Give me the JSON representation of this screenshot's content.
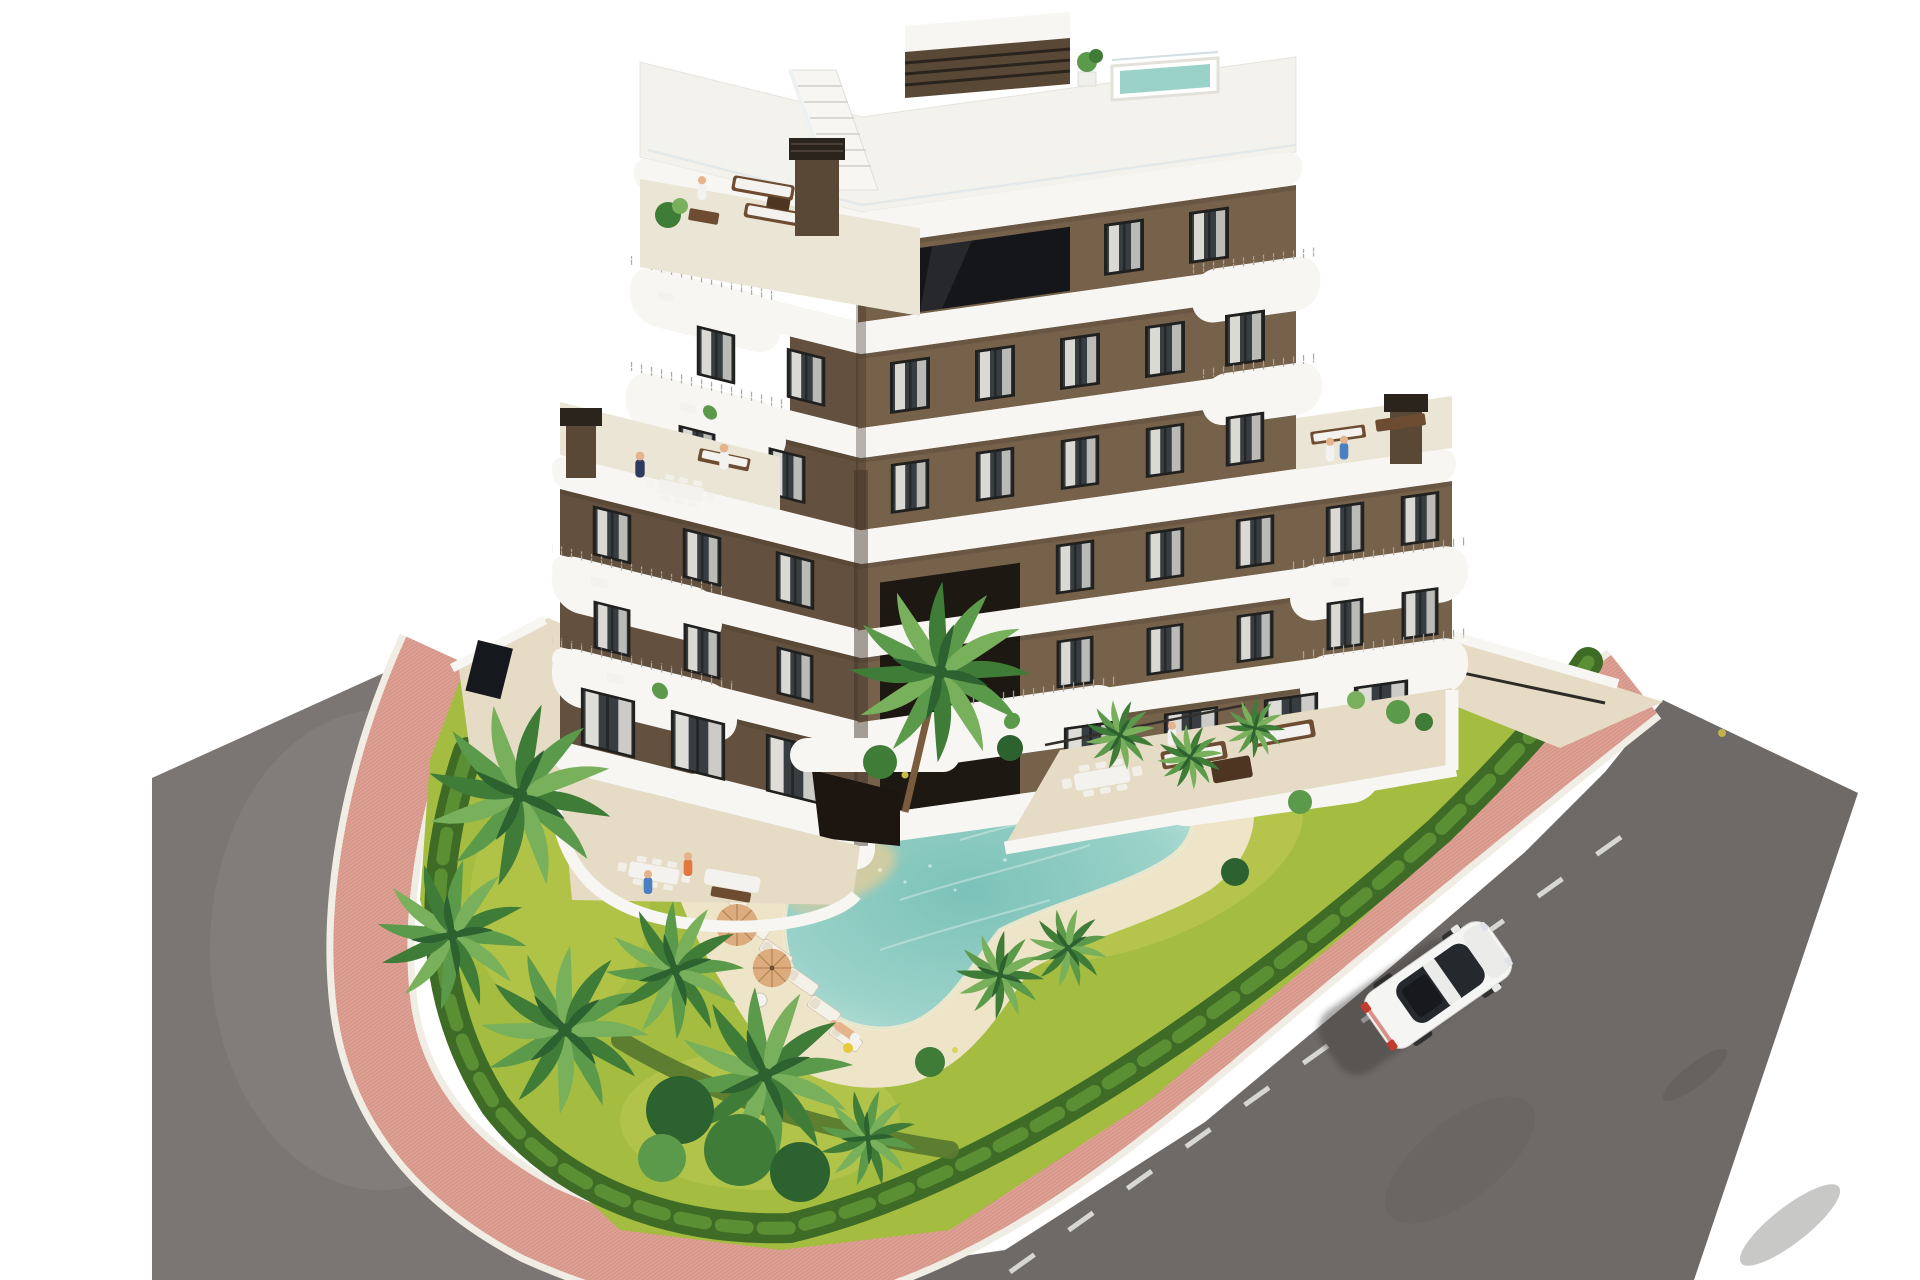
{
  "meta": {
    "description": "Aerial 3D architectural rendering of a modern seven-storey apartment building with dark-brown facades and white curved balcony bands, rooftop terraces with a small plunge pool, a landscaped garden with a free-form beach-entry swimming pool, sun loungers, parasols, palm trees, clipped hedges, a pink paved perimeter sidewalk and grey asphalt streets with one white car."
  },
  "scene": {
    "building": {
      "label": "apartment-building",
      "storeys": 7,
      "facade_color": "dark-brown",
      "balcony_color": "white",
      "features": [
        "rooftop-plunge-pool",
        "roof-stair-bulkhead",
        "chimneys",
        "glass-balustrades",
        "stepped-terraces",
        "terrace-furniture"
      ]
    },
    "garden": {
      "label": "landscaped-garden",
      "features": [
        "free-form-pool",
        "beach-entry",
        "sun-loungers",
        "parasols",
        "palm-trees",
        "hedges",
        "lawn",
        "rock-bed",
        "stone-ring",
        "garden-lamp"
      ]
    },
    "pool": {
      "label": "free-form-pool",
      "loungers": 7,
      "parasols": 3
    },
    "streets": {
      "left_road": "grey-asphalt",
      "right_road": "grey-asphalt",
      "sidewalk": "pink-paved-walk",
      "lane_marking": "dashed-white"
    },
    "car": {
      "label": "white-car",
      "color": "#f5f5f4",
      "heading": "north-east"
    },
    "people_visible": 12
  },
  "colors": {
    "bg": "#ffffff",
    "slab": "#f7f6f3",
    "slabShade": "#e4e1da",
    "roof": "#f4f2ec",
    "wallL": "#63503e",
    "wallR": "#76614b",
    "wallDark": "#3e3126",
    "winFrame": "#20201f",
    "winGlass": "#383d42",
    "curtain": "#edeae4",
    "glassDark": "#15161a",
    "terraceFloor": "#ebe5d6",
    "pavement": "#e6dcc6",
    "chimney": "#5a4836",
    "chimneyCap": "#2b241d",
    "lawn": "#a4bc3f",
    "lawnLight": "#c3cc56",
    "hedge": "#3e6b26",
    "hedgeLight": "#5f9636",
    "palm0": "#2c6130",
    "palm1": "#3f7c38",
    "palm2": "#5b9a4a",
    "palm3": "#78b05c",
    "trunk": "#7a5b3e",
    "deck": "#eee5c8",
    "poolWater": "#9ad2c9",
    "poolDeep": "#7cc2b8",
    "beach": "#d8cc9f",
    "stone": "#e9e7df",
    "pebble": "#bdbcb2",
    "pinkWalk": "#dfa094",
    "brick": "#b97e70",
    "curb": "#f0ede4",
    "roadL": "#7b7673",
    "roadR": "#6e6a67",
    "laneLine": "#e9e9e6",
    "carBody": "#f5f5f4",
    "carGlass": "#25282d",
    "tailLight": "#c23b2e",
    "wood": "#6e4c31",
    "woodDark": "#4e3522",
    "cushion": "#f3f2ee",
    "umbrella": "#dcab7e",
    "umbrellaRib": "#b98757",
    "skin": "#e6b48c"
  }
}
